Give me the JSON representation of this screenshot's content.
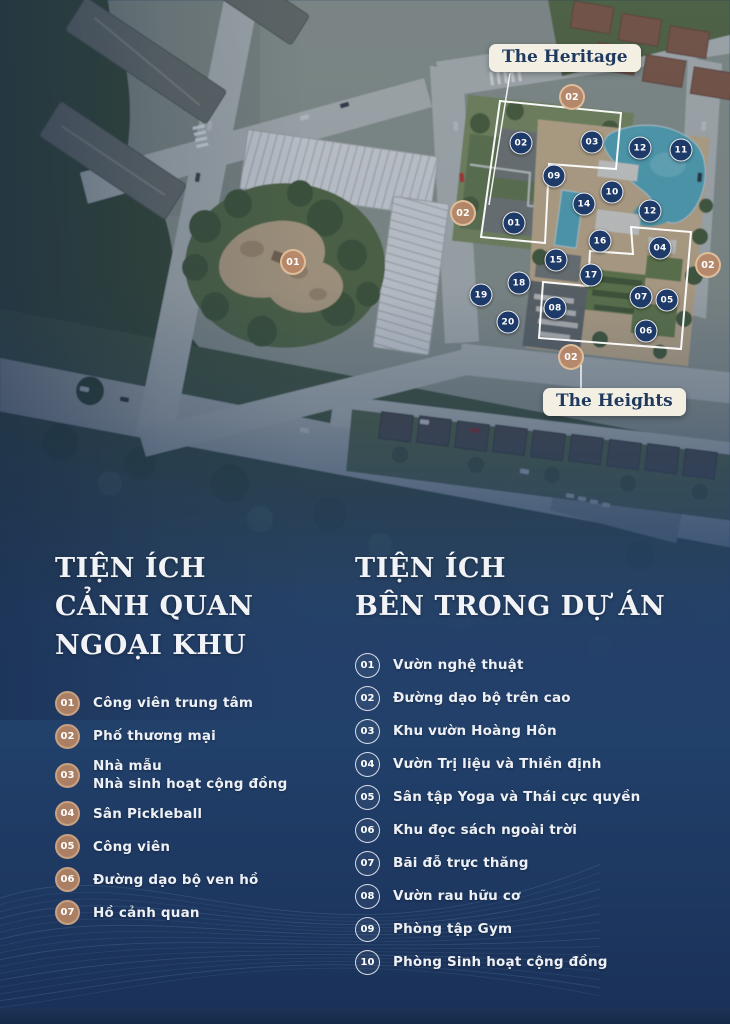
{
  "page": {
    "width": 730,
    "height": 1024
  },
  "colors": {
    "background_navy": "#23406b",
    "badge_tan": "#ab7f63",
    "marker_navy": "#1e3a68",
    "label_cream": "#f4efe3",
    "pool_blue": "#5db6c6"
  },
  "map": {
    "labels": {
      "heritage": "The Heritage",
      "heights": "The Heights"
    },
    "navy_markers": [
      {
        "n": "02",
        "x": 521,
        "y": 143
      },
      {
        "n": "03",
        "x": 592,
        "y": 142
      },
      {
        "n": "12",
        "x": 640,
        "y": 148
      },
      {
        "n": "11",
        "x": 681,
        "y": 150
      },
      {
        "n": "09",
        "x": 554,
        "y": 176
      },
      {
        "n": "10",
        "x": 612,
        "y": 192
      },
      {
        "n": "14",
        "x": 584,
        "y": 204
      },
      {
        "n": "12",
        "x": 650,
        "y": 211
      },
      {
        "n": "01",
        "x": 514,
        "y": 223
      },
      {
        "n": "16",
        "x": 600,
        "y": 241
      },
      {
        "n": "04",
        "x": 660,
        "y": 248
      },
      {
        "n": "15",
        "x": 556,
        "y": 260
      },
      {
        "n": "17",
        "x": 591,
        "y": 275
      },
      {
        "n": "18",
        "x": 519,
        "y": 283
      },
      {
        "n": "19",
        "x": 481,
        "y": 295
      },
      {
        "n": "07",
        "x": 641,
        "y": 297
      },
      {
        "n": "05",
        "x": 667,
        "y": 300
      },
      {
        "n": "08",
        "x": 555,
        "y": 308
      },
      {
        "n": "20",
        "x": 508,
        "y": 322
      },
      {
        "n": "06",
        "x": 646,
        "y": 331
      }
    ],
    "tan_markers": [
      {
        "n": "02",
        "x": 572,
        "y": 97
      },
      {
        "n": "02",
        "x": 463,
        "y": 213
      },
      {
        "n": "02",
        "x": 708,
        "y": 265
      },
      {
        "n": "02",
        "x": 571,
        "y": 357
      },
      {
        "n": "01",
        "x": 293,
        "y": 262
      }
    ]
  },
  "left_section": {
    "title_lines": [
      "TIỆN ÍCH",
      "CẢNH QUAN",
      "NGOẠI KHU"
    ],
    "items": [
      {
        "num": "01",
        "label": "Công viên trung tâm"
      },
      {
        "num": "02",
        "label": "Phố thương mại"
      },
      {
        "num": "03",
        "label": "Nhà mẫu\nNhà sinh hoạt cộng đồng"
      },
      {
        "num": "04",
        "label": "Sân Pickleball"
      },
      {
        "num": "05",
        "label": "Công viên"
      },
      {
        "num": "06",
        "label": "Đường dạo bộ ven hồ"
      },
      {
        "num": "07",
        "label": "Hồ cảnh quan"
      }
    ]
  },
  "right_section": {
    "title_lines": [
      "TIỆN ÍCH",
      "BÊN TRONG DỰ ÁN"
    ],
    "items": [
      {
        "num": "01",
        "label": "Vườn nghệ thuật"
      },
      {
        "num": "02",
        "label": "Đường dạo bộ trên cao"
      },
      {
        "num": "03",
        "label": "Khu vườn Hoàng Hôn"
      },
      {
        "num": "04",
        "label": "Vườn Trị liệu và Thiền định"
      },
      {
        "num": "05",
        "label": "Sân tập Yoga và Thái cực quyền"
      },
      {
        "num": "06",
        "label": "Khu đọc sách ngoài trời"
      },
      {
        "num": "07",
        "label": "Bãi đỗ trực thăng"
      },
      {
        "num": "08",
        "label": "Vườn rau hữu cơ"
      },
      {
        "num": "09",
        "label": "Phòng tập Gym"
      },
      {
        "num": "10",
        "label": "Phòng Sinh hoạt cộng đồng"
      }
    ]
  }
}
